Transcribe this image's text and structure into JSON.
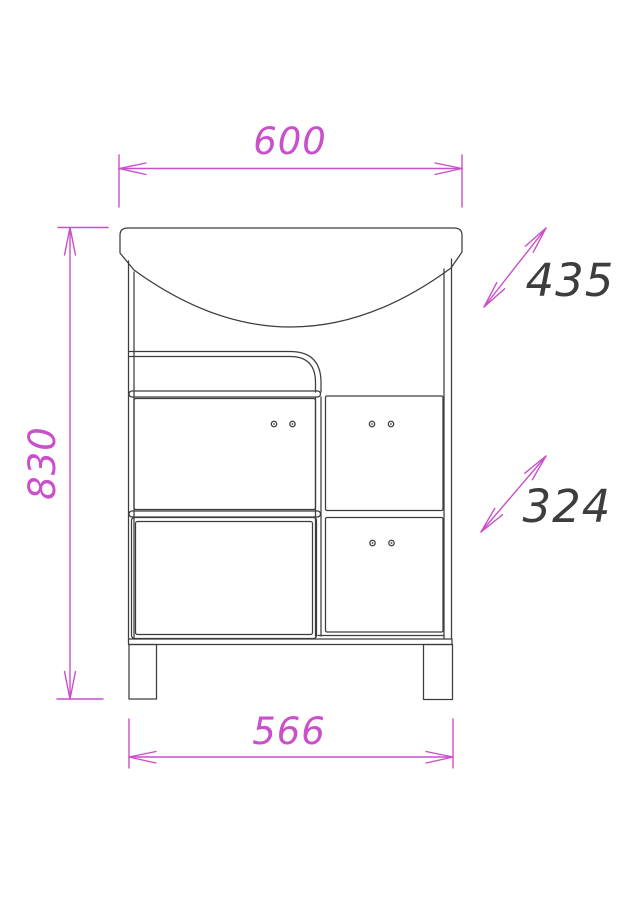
{
  "dimensions": {
    "top_width": "600",
    "overall_height": "830",
    "upper_depth": "435",
    "lower_depth": "324",
    "base_width": "566"
  },
  "colors": {
    "dimension_lines": "#ca4fca",
    "drawing_lines": "#3d3d3d",
    "background": "#ffffff"
  }
}
